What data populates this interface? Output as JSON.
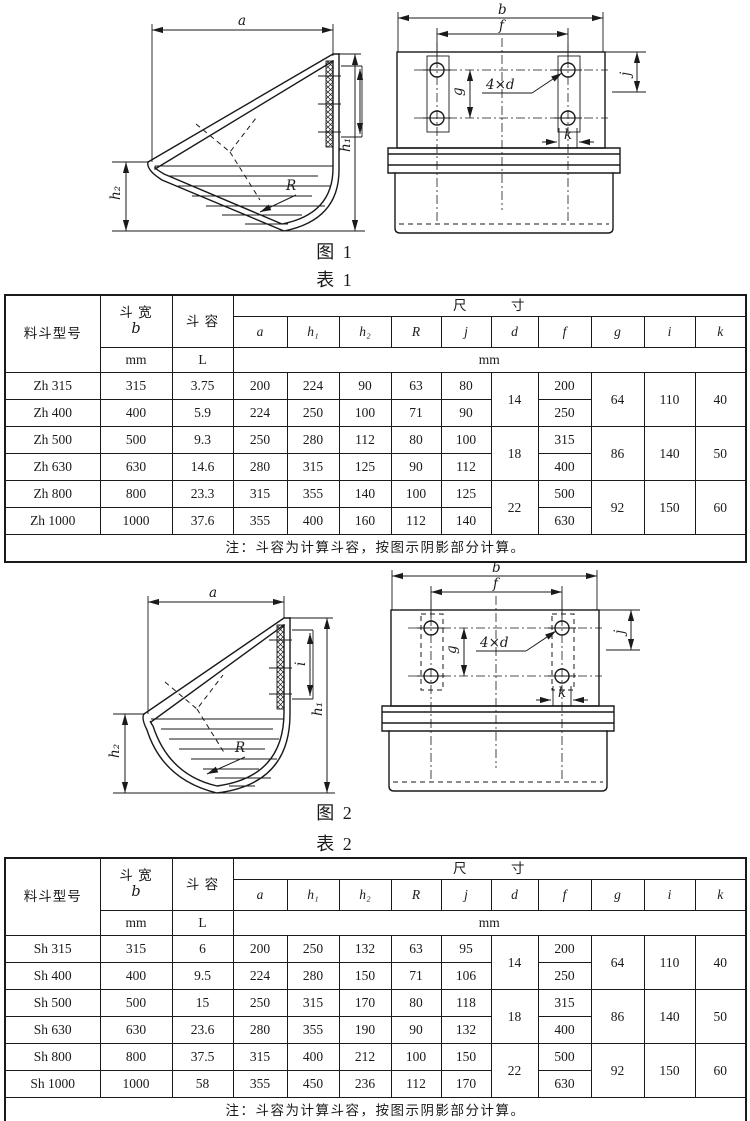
{
  "figure1": {
    "caption": "图  1",
    "side": {
      "a": "a",
      "h1": "h₁",
      "h2": "h₂",
      "R": "R"
    },
    "front": {
      "b": "b",
      "f": "f",
      "g": "g",
      "d": "4×d",
      "j": "j",
      "k": "k"
    }
  },
  "figure2": {
    "caption": "图  2",
    "side": {
      "a": "a",
      "h1": "h₁",
      "h2": "h₂",
      "R": "R",
      "i": "i"
    },
    "front": {
      "b": "b",
      "f": "f",
      "g": "g",
      "d": "4×d",
      "j": "j",
      "k": "k"
    }
  },
  "table1": {
    "caption": "表  1",
    "header": {
      "model": "料斗型号",
      "width_cn": "斗  宽",
      "width_sym": "b",
      "capacity": "斗  容",
      "dims": "尺　　　寸",
      "letters": [
        "a",
        "h₁",
        "h₂",
        "R",
        "j",
        "d",
        "f",
        "g",
        "i",
        "k"
      ],
      "unit_b": "mm",
      "unit_capacity": "L",
      "unit_dims": "mm"
    },
    "rows": [
      {
        "model": "Zh 315",
        "b": "315",
        "cap": "3.75",
        "a": "200",
        "h1": "224",
        "h2": "90",
        "R": "63",
        "j": "80",
        "f": "200"
      },
      {
        "model": "Zh 400",
        "b": "400",
        "cap": "5.9",
        "a": "224",
        "h1": "250",
        "h2": "100",
        "R": "71",
        "j": "90",
        "f": "250"
      },
      {
        "model": "Zh 500",
        "b": "500",
        "cap": "9.3",
        "a": "250",
        "h1": "280",
        "h2": "112",
        "R": "80",
        "j": "100",
        "f": "315"
      },
      {
        "model": "Zh 630",
        "b": "630",
        "cap": "14.6",
        "a": "280",
        "h1": "315",
        "h2": "125",
        "R": "90",
        "j": "112",
        "f": "400"
      },
      {
        "model": "Zh 800",
        "b": "800",
        "cap": "23.3",
        "a": "315",
        "h1": "355",
        "h2": "140",
        "R": "100",
        "j": "125",
        "f": "500"
      },
      {
        "model": "Zh 1000",
        "b": "1000",
        "cap": "37.6",
        "a": "355",
        "h1": "400",
        "h2": "160",
        "R": "112",
        "j": "140",
        "f": "630"
      }
    ],
    "groups": [
      {
        "d": "14",
        "g": "64",
        "i": "110",
        "k": "40"
      },
      {
        "d": "18",
        "g": "86",
        "i": "140",
        "k": "50"
      },
      {
        "d": "22",
        "g": "92",
        "i": "150",
        "k": "60"
      }
    ],
    "note": "注：斗容为计算斗容，按图示阴影部分计算。"
  },
  "table2": {
    "caption": "表  2",
    "header": {
      "model": "料斗型号",
      "width_cn": "斗  宽",
      "width_sym": "b",
      "capacity": "斗  容",
      "dims": "尺　　　寸",
      "letters": [
        "a",
        "h₁",
        "h₂",
        "R",
        "j",
        "d",
        "f",
        "g",
        "i",
        "k"
      ],
      "unit_b": "mm",
      "unit_capacity": "L",
      "unit_dims": "mm"
    },
    "rows": [
      {
        "model": "Sh 315",
        "b": "315",
        "cap": "6",
        "a": "200",
        "h1": "250",
        "h2": "132",
        "R": "63",
        "j": "95",
        "f": "200"
      },
      {
        "model": "Sh 400",
        "b": "400",
        "cap": "9.5",
        "a": "224",
        "h1": "280",
        "h2": "150",
        "R": "71",
        "j": "106",
        "f": "250"
      },
      {
        "model": "Sh 500",
        "b": "500",
        "cap": "15",
        "a": "250",
        "h1": "315",
        "h2": "170",
        "R": "80",
        "j": "118",
        "f": "315"
      },
      {
        "model": "Sh 630",
        "b": "630",
        "cap": "23.6",
        "a": "280",
        "h1": "355",
        "h2": "190",
        "R": "90",
        "j": "132",
        "f": "400"
      },
      {
        "model": "Sh 800",
        "b": "800",
        "cap": "37.5",
        "a": "315",
        "h1": "400",
        "h2": "212",
        "R": "100",
        "j": "150",
        "f": "500"
      },
      {
        "model": "Sh 1000",
        "b": "1000",
        "cap": "58",
        "a": "355",
        "h1": "450",
        "h2": "236",
        "R": "112",
        "j": "170",
        "f": "630"
      }
    ],
    "groups": [
      {
        "d": "14",
        "g": "64",
        "i": "110",
        "k": "40"
      },
      {
        "d": "18",
        "g": "86",
        "i": "140",
        "k": "50"
      },
      {
        "d": "22",
        "g": "92",
        "i": "150",
        "k": "60"
      }
    ],
    "note": "注：斗容为计算斗容，按图示阴影部分计算。"
  }
}
